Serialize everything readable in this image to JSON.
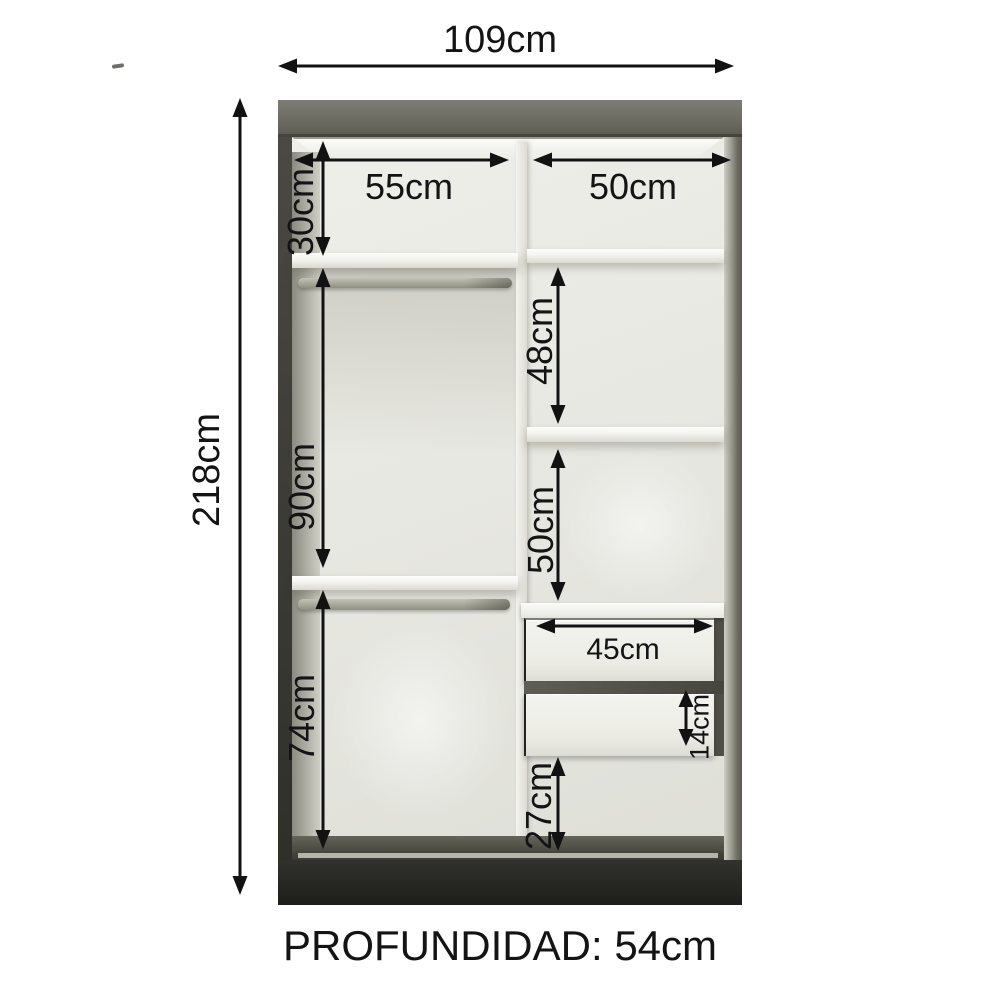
{
  "diagram": {
    "type": "wardrobe-interior-dimension-diagram",
    "footer_label": "PROFUNDIDAD: 54cm",
    "depth_value": "54cm",
    "dims": {
      "total_width": "109cm",
      "total_height": "218cm",
      "upper_left_width": "55cm",
      "upper_right_width": "50cm",
      "upper_shelf_height": "30cm",
      "left_hanging_height": "90cm",
      "left_lower_hanging_height": "74cm",
      "right_upper_section_height": "48cm",
      "right_middle_section_height": "50cm",
      "drawer_width": "45cm",
      "drawer_front_height": "14cm",
      "right_lower_section_height": "27cm"
    },
    "colors": {
      "background": "#ffffff",
      "frame_top_olive": "#6c6c62",
      "frame_dark": "#2e2e29",
      "interior_light": "#e9e9e3",
      "dimension_lines": "#121212"
    }
  }
}
